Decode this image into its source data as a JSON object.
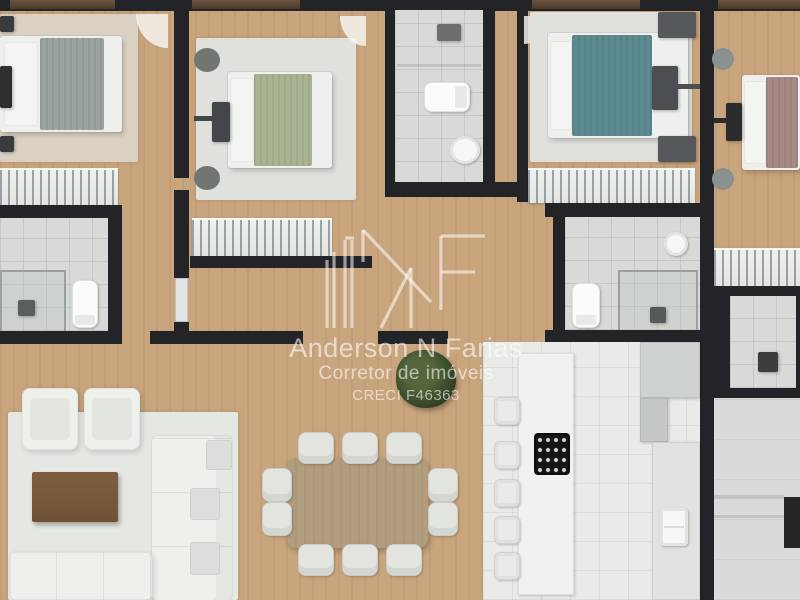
{
  "watermark": {
    "logo_icon": "anf-monogram-icon",
    "line1": "Anderson N Farias",
    "line2": "Corretor de imóveis",
    "line3": "CRECI F46363"
  },
  "palette": {
    "wood_floor": "#c9a57d",
    "wall": "#232428",
    "bath_tile": "#d7dad7",
    "kitchen_tile": "#e9ebe8",
    "rug_beige": "#dad1c3",
    "rug_gray": "#e0e1dd",
    "bed_white": "#eff0ed",
    "blanket_sage": "#a9b392",
    "blanket_teal": "#5d8b94",
    "blanket_mauve": "#a78a83",
    "duvet_gray": "#9ca4a2",
    "dining_table_wood": "#b29d7f",
    "coffee_table_wood": "#6f5236",
    "sofa_white": "#eef0ec",
    "counter_gray": "#ced2d0",
    "cooktop": "#161617",
    "plant_green": "#3f5230",
    "watermark": "rgba(255,255,255,0.55)"
  },
  "rooms": [
    {
      "id": "bedroom-1"
    },
    {
      "id": "bedroom-2"
    },
    {
      "id": "bedroom-3"
    },
    {
      "id": "bedroom-4"
    },
    {
      "id": "bathroom-1"
    },
    {
      "id": "bathroom-2"
    },
    {
      "id": "bathroom-3"
    },
    {
      "id": "hallway"
    },
    {
      "id": "living-room"
    },
    {
      "id": "dining-room"
    },
    {
      "id": "kitchen"
    },
    {
      "id": "service-area"
    }
  ]
}
